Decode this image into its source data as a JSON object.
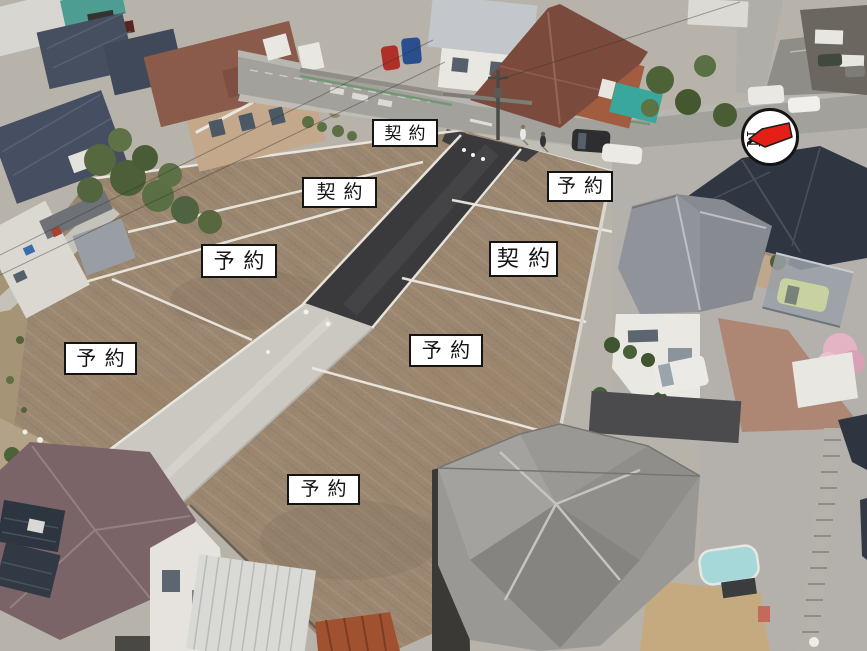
{
  "plot_labels": [
    {
      "text": "契約",
      "left": 372,
      "top": 119,
      "width": 66,
      "height": 28
    },
    {
      "text": "契約",
      "left": 302,
      "top": 177,
      "width": 75,
      "height": 31
    },
    {
      "text": "予約",
      "left": 547,
      "top": 171,
      "width": 66,
      "height": 31
    },
    {
      "text": "予約",
      "left": 201,
      "top": 244,
      "width": 76,
      "height": 34
    },
    {
      "text": "契約",
      "left": 489,
      "top": 241,
      "width": 69,
      "height": 36
    },
    {
      "text": "予約",
      "left": 64,
      "top": 342,
      "width": 73,
      "height": 33
    },
    {
      "text": "予約",
      "left": 409,
      "top": 334,
      "width": 74,
      "height": 33
    },
    {
      "text": "予約",
      "left": 287,
      "top": 474,
      "width": 73,
      "height": 31
    }
  ],
  "compass": {
    "label": "N",
    "arrow_color": "#e31f16"
  },
  "colors": {
    "label_background": "#ffffff",
    "label_border": "#141414",
    "label_text": "#141414",
    "compass_arrow": "#e31f16"
  }
}
